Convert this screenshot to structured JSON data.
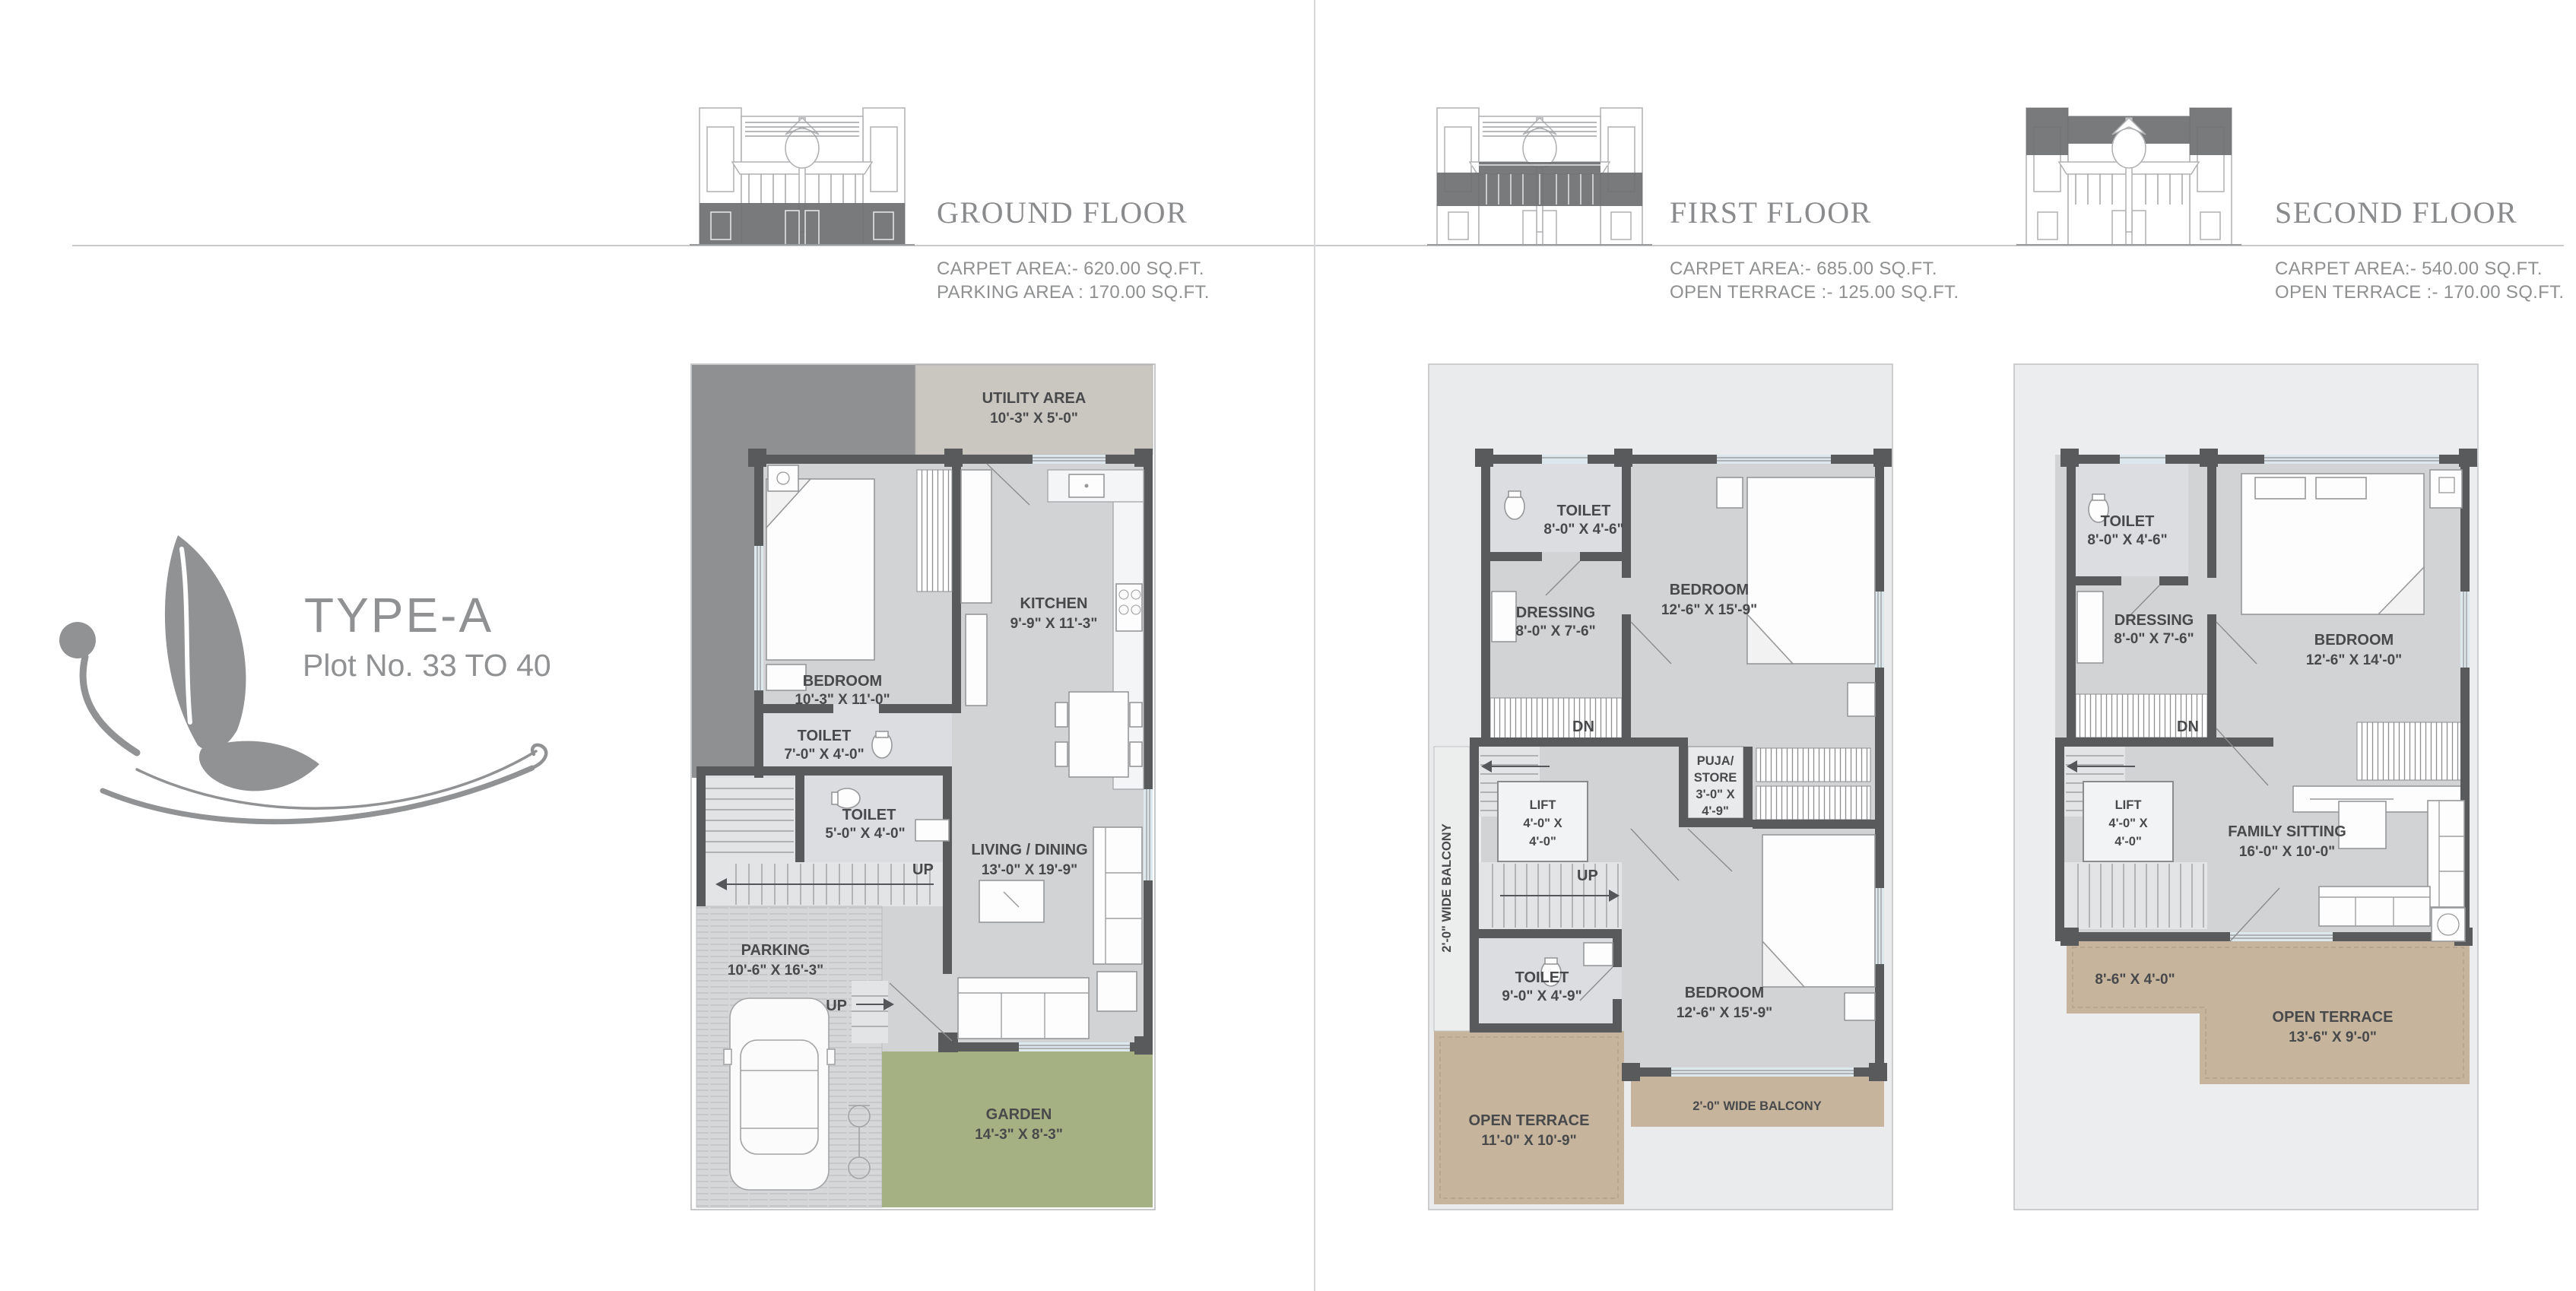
{
  "logo": {
    "type": "TYPE-A",
    "plot": "Plot No. 33 TO 40"
  },
  "floors": [
    {
      "title": "GROUND FLOOR",
      "areas": [
        "CARPET AREA:- 620.00 SQ.FT.",
        "PARKING AREA : 170.00 SQ.FT."
      ],
      "labels": {
        "utility_name": "UTILITY AREA",
        "utility_dims": "10'-3\" X 5'-0\"",
        "bedroom_name": "BEDROOM",
        "bedroom_dims": "10'-3\" X 11'-0\"",
        "kitchen_name": "KITCHEN",
        "kitchen_dims": "9'-9\" X 11'-3\"",
        "toilet1_name": "TOILET",
        "toilet1_dims": "7'-0\" X 4'-0\"",
        "toilet2_name": "TOILET",
        "toilet2_dims": "5'-0\" X 4'-0\"",
        "living_name": "LIVING / DINING",
        "living_dims": "13'-0\" X 19'-9\"",
        "parking_name": "PARKING",
        "parking_dims": "10'-6\" X 16'-3\"",
        "garden_name": "GARDEN",
        "garden_dims": "14'-3\" X 8'-3\"",
        "up_stairs": "UP",
        "up_entry": "UP"
      }
    },
    {
      "title": "FIRST FLOOR",
      "areas": [
        "CARPET AREA:- 685.00 SQ.FT.",
        "OPEN TERRACE :- 125.00 SQ.FT."
      ],
      "labels": {
        "toilet1_name": "TOILET",
        "toilet1_dims": "8'-0\" X 4'-6\"",
        "dressing_name": "DRESSING",
        "dressing_dims": "8'-0\" X 7'-6\"",
        "bedroom1_name": "BEDROOM",
        "bedroom1_dims": "12'-6\" X 15'-9\"",
        "bedroom2_name": "BEDROOM",
        "bedroom2_dims": "12'-6\" X 15'-9\"",
        "toilet2_name": "TOILET",
        "toilet2_dims": "9'-0\" X 4'-9\"",
        "lift_name": "LIFT",
        "lift_dims1": "4'-0\" X",
        "lift_dims2": "4'-0\"",
        "puja_l1": "PUJA/",
        "puja_l2": "STORE",
        "puja_l3": "3'-0\" X",
        "puja_l4": "4'-9\"",
        "terrace_name": "OPEN TERRACE",
        "terrace_dims": "11'-0\" X 10'-9\"",
        "balcony_left": "2'-0\" WIDE BALCONY",
        "balcony_bottom": "2'-0\" WIDE BALCONY",
        "dn": "DN",
        "up": "UP"
      }
    },
    {
      "title": "SECOND FLOOR",
      "areas": [
        "CARPET AREA:- 540.00 SQ.FT.",
        "OPEN TERRACE :- 170.00 SQ.FT."
      ],
      "labels": {
        "toilet_name": "TOILET",
        "toilet_dims": "8'-0\" X 4'-6\"",
        "dressing_name": "DRESSING",
        "dressing_dims": "8'-0\" X 7'-6\"",
        "bedroom_name": "BEDROOM",
        "bedroom_dims": "12'-6\" X 14'-0\"",
        "lift_name": "LIFT",
        "lift_dims1": "4'-0\" X",
        "lift_dims2": "4'-0\"",
        "family_name": "FAMILY SITTING",
        "family_dims": "16'-0\" X 10'-0\"",
        "terrace_small_dims": "8'-6\" X 4'-0\"",
        "terrace_name": "OPEN TERRACE",
        "terrace_dims": "13'-6\" X 9'-0\"",
        "dn": "DN"
      }
    }
  ]
}
